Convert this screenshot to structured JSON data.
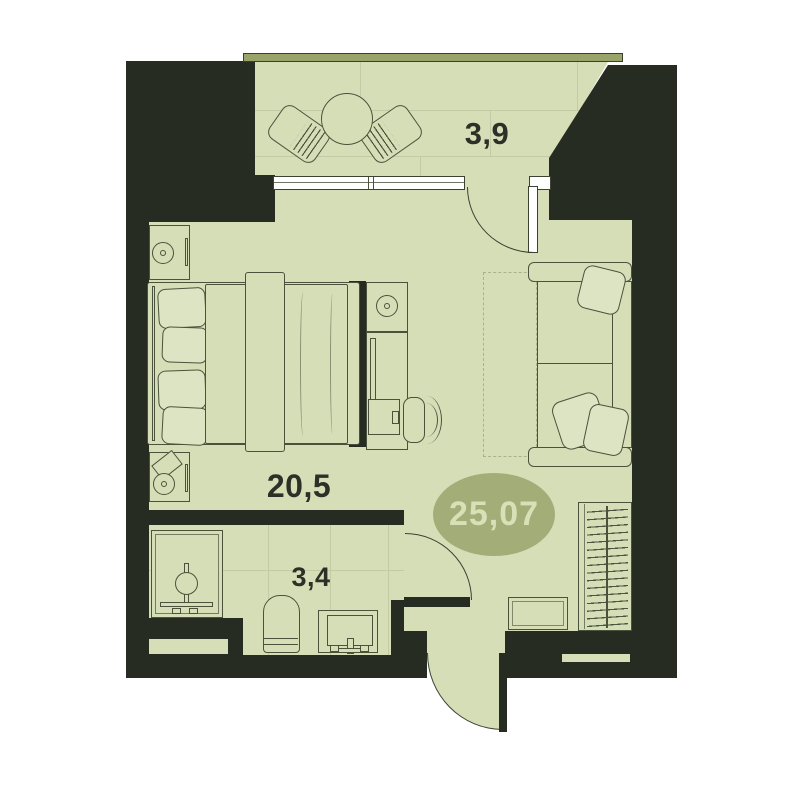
{
  "plan": {
    "type": "apartment-floor-plan",
    "total_area": "25,07",
    "rooms": [
      {
        "name": "living-bedroom",
        "area": "20,5"
      },
      {
        "name": "balcony",
        "area": "3,9"
      },
      {
        "name": "bathroom",
        "area": "3,4"
      }
    ],
    "colors": {
      "wall": "#272c23",
      "floor": "#d6deb8",
      "soft": "#dde4c3",
      "stroke": "#4a523c",
      "stroke_dark": "#3b4232",
      "railing": "#99a46a",
      "badge_fill": "#a3ad78",
      "badge_text": "#d8e0b7",
      "label": "#2b3126",
      "tile_line": "#c3cba4",
      "window_fill": "#ffffff"
    }
  }
}
